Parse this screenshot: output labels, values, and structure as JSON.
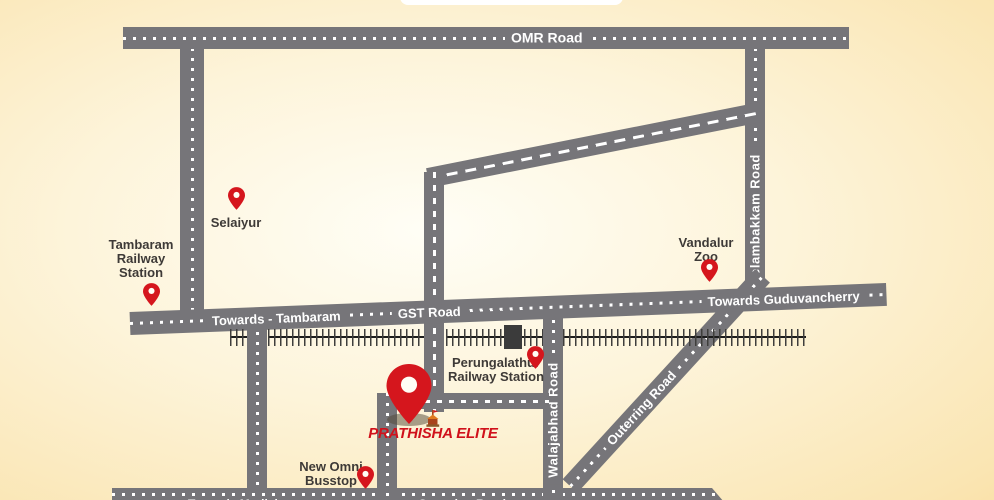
{
  "site": {
    "name": "PRATHISHA ELITE"
  },
  "roads": {
    "omr": {
      "label": "OMR Road"
    },
    "gst": {
      "towards_left": "Towards - Tambaram",
      "label": "GST Road",
      "towards_right": "Towards Guduvancherry"
    },
    "kelambakkam": {
      "label": "Kelambakkam Road"
    },
    "walajabhad": {
      "label": "Walajabhad Road"
    },
    "outerring": {
      "label": "Outerring Road"
    },
    "bottom": {
      "towards_left": "Towards Mudichur",
      "label": "Outerring Road"
    }
  },
  "landmarks": {
    "tambaram_station": {
      "lines": [
        "Tambaram",
        "Railway",
        "Station"
      ]
    },
    "selaiyur": {
      "lines": [
        "Selaiyur"
      ]
    },
    "vandalur_zoo": {
      "lines": [
        "Vandalur",
        "Zoo"
      ]
    },
    "perungalathur_station": {
      "lines": [
        "Perungalathur",
        "Railway Station"
      ]
    },
    "new_omni": {
      "lines": [
        "New Omni",
        "Busstop"
      ]
    }
  },
  "colors": {
    "road_gray": "#767579",
    "pin_red": "#d5161d",
    "label_dark": "#3e3a37",
    "brand_red": "#d0111b",
    "rail_dark": "#1c1c1c",
    "bg_center": "#fffef6",
    "bg_edge": "#f4c777"
  }
}
